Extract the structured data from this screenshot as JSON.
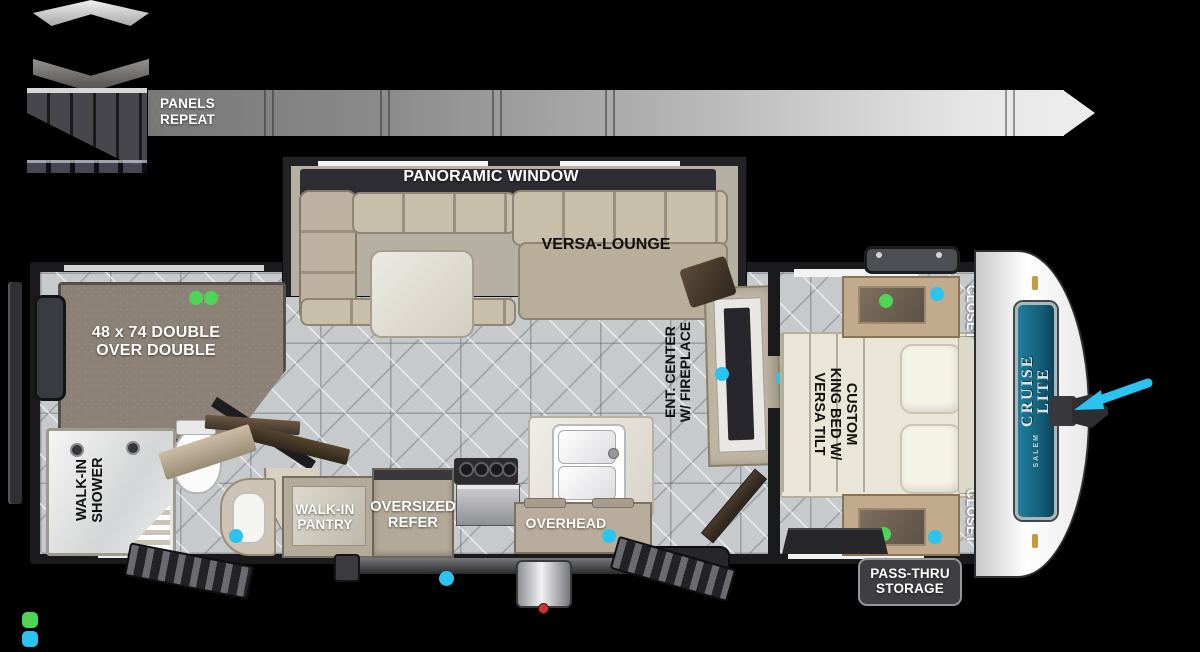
{
  "colors": {
    "marker_green": "#4ed457",
    "marker_cyan": "#2ac4f0",
    "brand_teal": "#17607c",
    "bar_gradient_start": "#7a7a7a",
    "bar_gradient_end": "#ececec"
  },
  "construction_legend": {
    "panels_repeat": "PANELS\nREPEAT"
  },
  "floorplan": {
    "labels": {
      "panoramic_window": "PANORAMIC WINDOW",
      "versa_lounge": "VERSA-LOUNGE",
      "bunk_bed": "48 x 74 DOUBLE\nOVER DOUBLE",
      "walk_in_shower": "WALK-IN\nSHOWER",
      "ent_center": "ENT. CENTER\nW/ FIREPLACE",
      "king_bed": "CUSTOM\nKING BED W/\nVERSA TILT",
      "closet_front_top": "CLOSET",
      "closet_front_bottom": "CLOSET",
      "walk_in_pantry": "WALK-IN\nPANTRY",
      "oversized_refer": "OVERSIZED\nREFER",
      "overhead": "OVERHEAD",
      "pass_thru_storage": "PASS-THRU\nSTORAGE"
    },
    "brand": {
      "name": "CRUISE\nLITE",
      "series": "SALEM"
    }
  }
}
